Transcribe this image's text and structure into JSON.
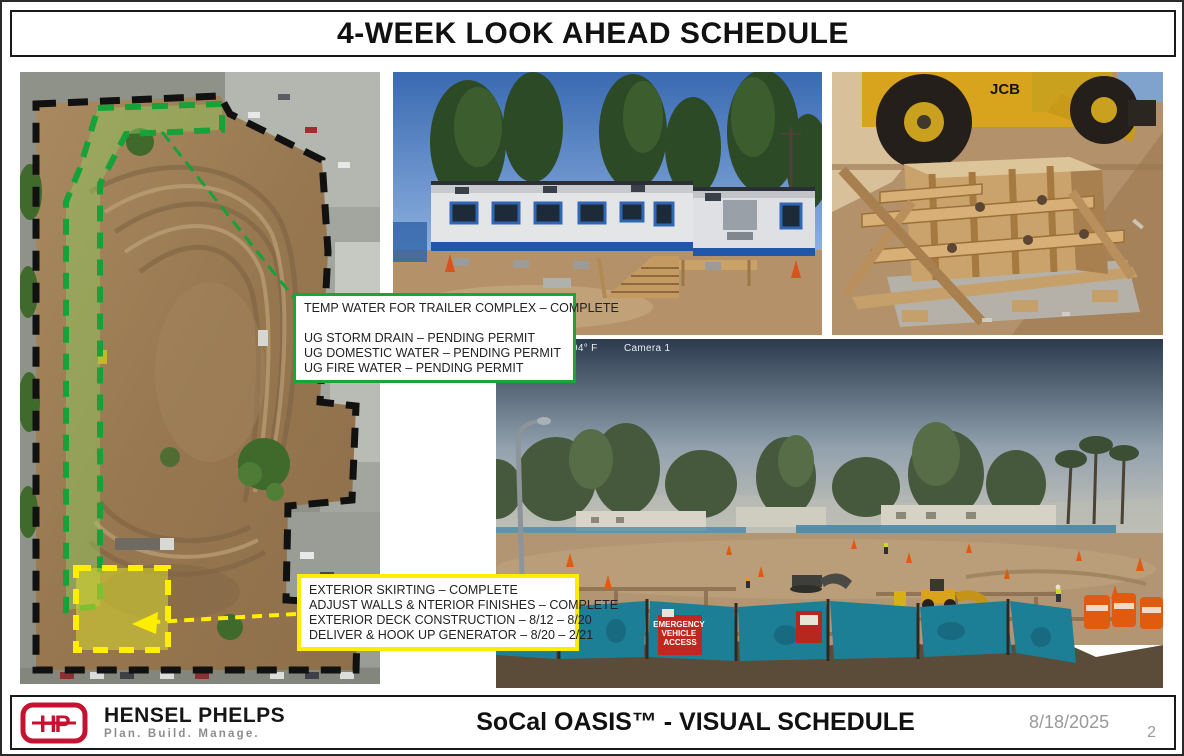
{
  "title": "4-WEEK LOOK AHEAD SCHEDULE",
  "colors": {
    "accent_green": "#1aa53c",
    "accent_yellow": "#ffec00",
    "brand_red": "#c41230",
    "boundary_black": "#111111"
  },
  "callouts": {
    "green": {
      "lines": [
        "TEMP WATER FOR TRAILER COMPLEX – COMPLETE",
        "",
        "UG STORM DRAIN – PENDING PERMIT",
        "UG DOMESTIC WATER – PENDING PERMIT",
        "UG FIRE WATER – PENDING PERMIT"
      ]
    },
    "yellow": {
      "lines": [
        "EXTERIOR SKIRTING – COMPLETE",
        "ADJUST WALLS & NTERIOR FINISHES – COMPLETE",
        "EXTERIOR DECK CONSTRUCTION – 8/12 – 8/20",
        "DELIVER & HOOK UP GENERATOR – 8/20 – 2/21"
      ]
    }
  },
  "webcam": {
    "temperature": "94° F",
    "camera_label": "Camera 1",
    "sign_lines": [
      "EMERGENCY",
      "VEHICLE",
      "ACCESS"
    ]
  },
  "equipment_brand": "JCB",
  "footer": {
    "company": "HENSEL PHELPS",
    "logo_monogram": "HP",
    "tagline": "Plan. Build. Manage.",
    "project_title": "SoCal OASIS™ - VISUAL SCHEDULE",
    "date": "8/18/2025",
    "page_number": "2"
  }
}
